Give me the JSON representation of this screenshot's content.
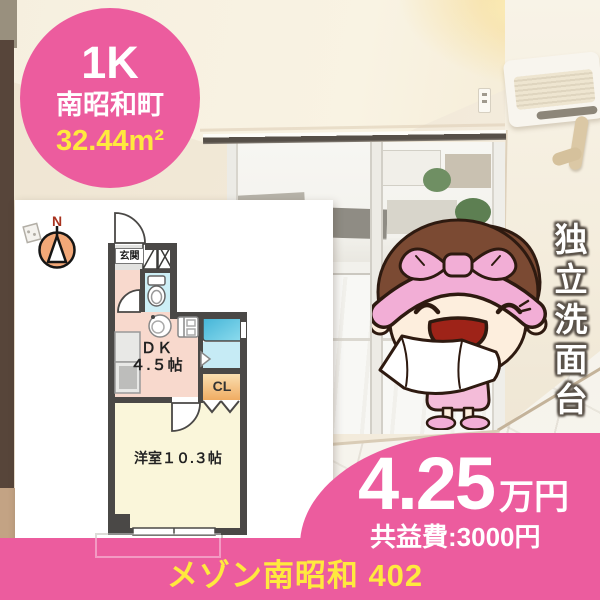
{
  "colors": {
    "brand_pink": "#ec5c9e",
    "accent_yellow": "#ffe93e",
    "plan_wall": "#4a4846"
  },
  "badge": {
    "layout": "1K",
    "district": "南昭和町",
    "area": "32.44m²"
  },
  "plan": {
    "north": "N",
    "entrance": "玄関",
    "dk_line1": "ＤＫ",
    "dk_line2": "４.５帖",
    "closet": "CL",
    "bedroom": "洋室１０.３帖"
  },
  "feature": {
    "vertical_label": "独立洗面台"
  },
  "price": {
    "amount": "4.25",
    "unit": "万円",
    "fee": "共益費:3000円"
  },
  "footer": {
    "property_name": "メゾン南昭和 402"
  }
}
